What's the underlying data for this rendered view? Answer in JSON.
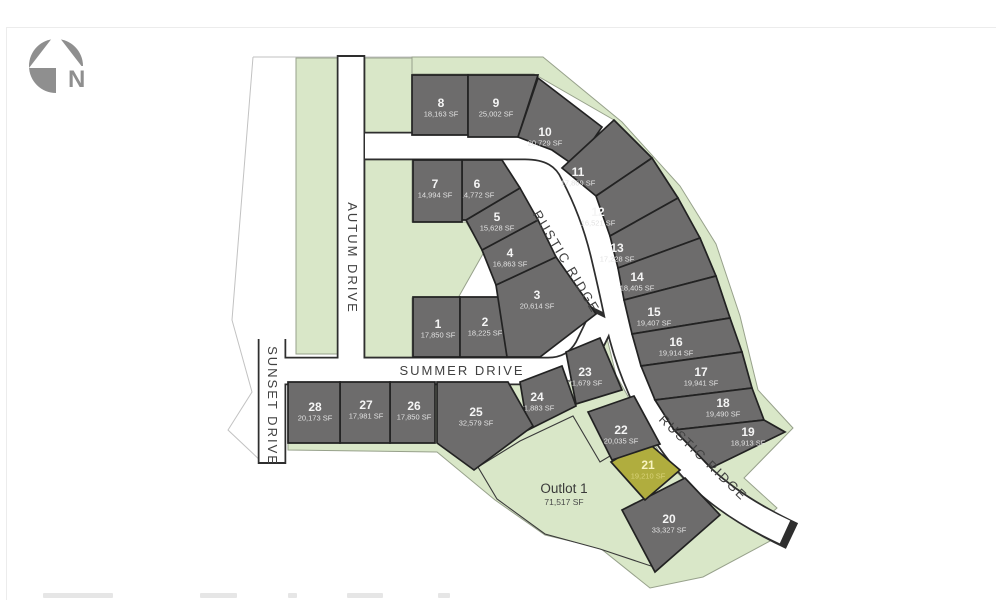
{
  "map": {
    "north_label": "N",
    "streets": {
      "autum": "AUTUM DRIVE",
      "sunset": "SUNSET DRIVE",
      "summer": "SUMMER DRIVE",
      "rustic": "RUSTIC RIDGE"
    },
    "colors": {
      "lot_gray": "#6d6c6c",
      "lot_highlight": "#b0ad3e",
      "green_space": "#d9e7c8",
      "road": "#ffffff",
      "road_outline": "#2e2e2e"
    },
    "outlot": {
      "name": "Outlot 1",
      "sf": "71,517 SF",
      "points": "478,467 520,441 573,416 600,462 620,450 648,498 628,508 657,568 600,549 545,534 497,499",
      "label": [
        564,
        489
      ]
    },
    "lots": [
      {
        "num": "1",
        "sf": "17,850 SF",
        "points": "413,297 460,297 460,357 413,357",
        "label": [
          438,
          324
        ]
      },
      {
        "num": "2",
        "sf": "18,225 SF",
        "points": "460,297 507,297 507,357 460,357",
        "label": [
          485,
          322
        ]
      },
      {
        "num": "3",
        "sf": "20,614 SF",
        "points": "496,285 556,257 596,314 540,357 507,357",
        "label": [
          537,
          295
        ]
      },
      {
        "num": "4",
        "sf": "16,863 SF",
        "points": "482,250 538,220 556,257 496,285",
        "label": [
          510,
          253
        ]
      },
      {
        "num": "5",
        "sf": "15,628 SF",
        "points": "466,220 520,188 538,220 482,250",
        "label": [
          497,
          217
        ]
      },
      {
        "num": "6",
        "sf": "14,772 SF",
        "points": "462,160 502,160 520,188 466,220 462,220",
        "label": [
          477,
          184
        ]
      },
      {
        "num": "7",
        "sf": "14,994 SF",
        "points": "413,160 462,160 462,222 413,222",
        "label": [
          435,
          184
        ]
      },
      {
        "num": "8",
        "sf": "18,163 SF",
        "points": "412,75 468,75 468,135 412,135",
        "label": [
          441,
          103
        ]
      },
      {
        "num": "9",
        "sf": "25,002 SF",
        "points": "468,75 538,75 518,137 468,137",
        "label": [
          496,
          103
        ]
      },
      {
        "num": "10",
        "sf": "20,729 SF",
        "points": "538,78 602,127 575,166 552,150 518,137",
        "label": [
          545,
          132
        ]
      },
      {
        "num": "11",
        "sf": "17,869 SF",
        "points": "562,168 614,120 652,158 596,196",
        "label": [
          578,
          172
        ]
      },
      {
        "num": "12",
        "sf": "16,521 SF",
        "points": "596,196 652,158 678,198 610,236",
        "label": [
          598,
          212
        ]
      },
      {
        "num": "13",
        "sf": "17,228 SF",
        "points": "610,236 678,198 700,238 618,268",
        "label": [
          617,
          248
        ]
      },
      {
        "num": "14",
        "sf": "18,405 SF",
        "points": "618,268 700,238 716,276 624,300",
        "label": [
          637,
          277
        ]
      },
      {
        "num": "15",
        "sf": "19,407 SF",
        "points": "624,300 716,276 730,318 632,334",
        "label": [
          654,
          312
        ]
      },
      {
        "num": "16",
        "sf": "19,914 SF",
        "points": "632,334 730,318 742,352 641,366",
        "label": [
          676,
          342
        ]
      },
      {
        "num": "17",
        "sf": "19,941 SF",
        "points": "641,366 742,352 752,388 655,400",
        "label": [
          701,
          372
        ]
      },
      {
        "num": "18",
        "sf": "19,490 SF",
        "points": "655,400 752,388 764,420 674,430",
        "label": [
          723,
          403
        ]
      },
      {
        "num": "19",
        "sf": "18,913 SF",
        "points": "674,430 764,420 785,432 711,468 682,438",
        "label": [
          748,
          432
        ]
      },
      {
        "num": "20",
        "sf": "33,327 SF",
        "points": "685,478 720,515 655,572 622,510",
        "label": [
          669,
          519
        ]
      },
      {
        "num": "21",
        "sf": "19,210 SF",
        "points": "611,462 646,441 680,470 645,500",
        "label": [
          648,
          465
        ],
        "hl": true
      },
      {
        "num": "22",
        "sf": "20,035 SF",
        "points": "588,412 634,396 660,444 612,460",
        "label": [
          621,
          430
        ]
      },
      {
        "num": "23",
        "sf": "21,679 SF",
        "points": "566,352 600,338 622,390 576,404",
        "label": [
          585,
          372
        ]
      },
      {
        "num": "24",
        "sf": "21,883 SF",
        "points": "520,382 562,366 576,406 528,430",
        "label": [
          537,
          397
        ]
      },
      {
        "num": "25",
        "sf": "32,579 SF",
        "points": "437,382 508,382 533,426 474,470 437,443",
        "label": [
          476,
          412
        ]
      },
      {
        "num": "26",
        "sf": "17,850 SF",
        "points": "390,382 435,382 435,443 390,443",
        "label": [
          414,
          406
        ]
      },
      {
        "num": "27",
        "sf": "17,981 SF",
        "points": "340,382 390,382 390,443 340,443",
        "label": [
          366,
          405
        ]
      },
      {
        "num": "28",
        "sf": "20,173 SF",
        "points": "288,382 340,382 340,443 288,443",
        "label": [
          315,
          407
        ]
      }
    ]
  }
}
